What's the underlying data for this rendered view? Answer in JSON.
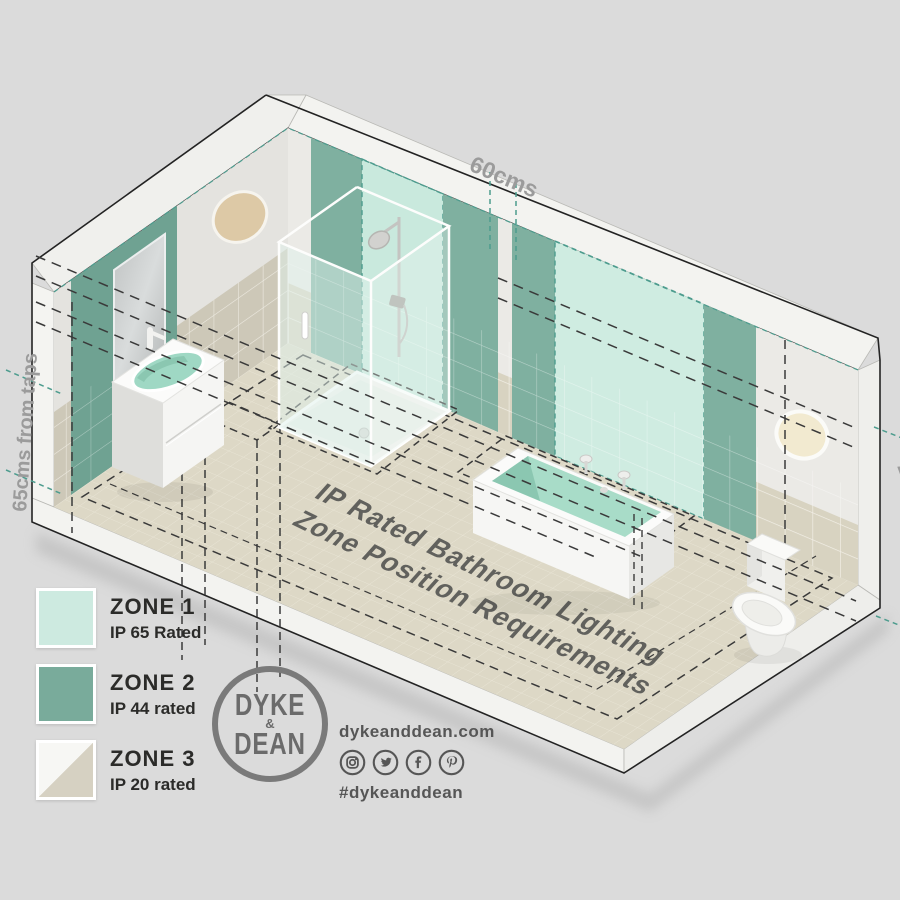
{
  "background_color": "#dbdbdb",
  "diagram": {
    "title_line1": "IP Rated Bathroom Lighting",
    "title_line2": "Zone Position Requirements",
    "dimension_top": "60cms",
    "dimension_left": "65cms from taps",
    "dimension_right": "225cms"
  },
  "legend": {
    "items": [
      {
        "zone": "ZONE 1",
        "rating": "IP 65 Rated",
        "color": "#cdeae0"
      },
      {
        "zone": "ZONE 2",
        "rating": "IP 44 rated",
        "color": "#79ab9b"
      },
      {
        "zone": "ZONE 3",
        "rating": "IP 20 rated",
        "color": "#d6d1c2",
        "color2": "#f7f7f4"
      }
    ]
  },
  "brand": {
    "logo_top": "DYKE",
    "logo_amp": "&",
    "logo_bottom": "DEAN",
    "website": "dykeanddean.com",
    "hashtag": "#dykeanddean",
    "social_icons": [
      "instagram-icon",
      "twitter-icon",
      "facebook-icon",
      "pinterest-icon"
    ]
  },
  "zone_colors": {
    "zone1_mint": "#cdeae0",
    "zone2_green": "#79ab9b",
    "zone3_beige": "#d6d1c2",
    "dash_teal": "#4d9c8e",
    "dash_black": "#3a3a3a",
    "dimension_text": "#9b9b9b"
  }
}
